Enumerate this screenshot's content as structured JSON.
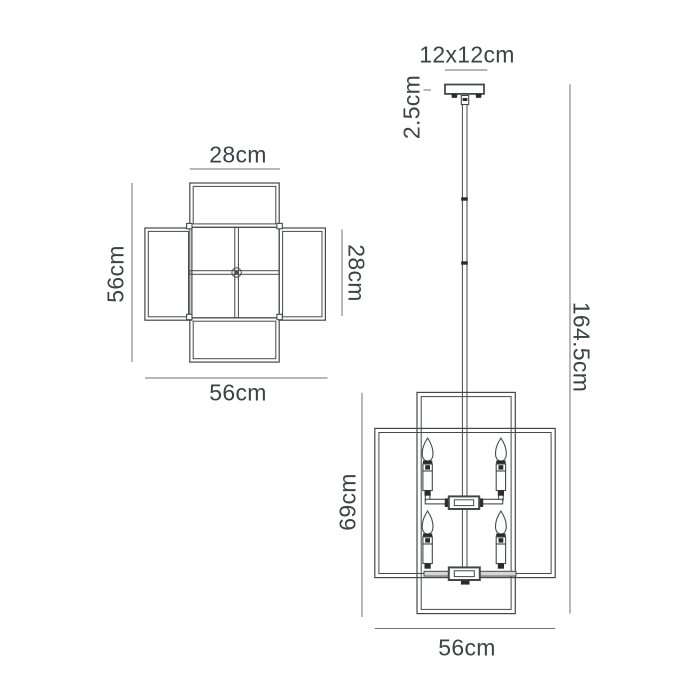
{
  "diagram": {
    "colors": {
      "line": "#454849",
      "dim_line": "#707070",
      "text": "#3e4244",
      "fill_dark": "#2b2b2b",
      "fill_gray": "#d6d6d6",
      "background": "#ffffff"
    },
    "plan_view": {
      "dim_top": "28cm",
      "dim_left": "56cm",
      "dim_right": "28cm",
      "dim_bottom": "56cm"
    },
    "front_view": {
      "dim_canopy": "12x12cm",
      "dim_canopy_drop": "2.5cm",
      "dim_overall_drop": "164.5cm",
      "dim_body_height": "69cm",
      "dim_body_width": "56cm"
    }
  }
}
